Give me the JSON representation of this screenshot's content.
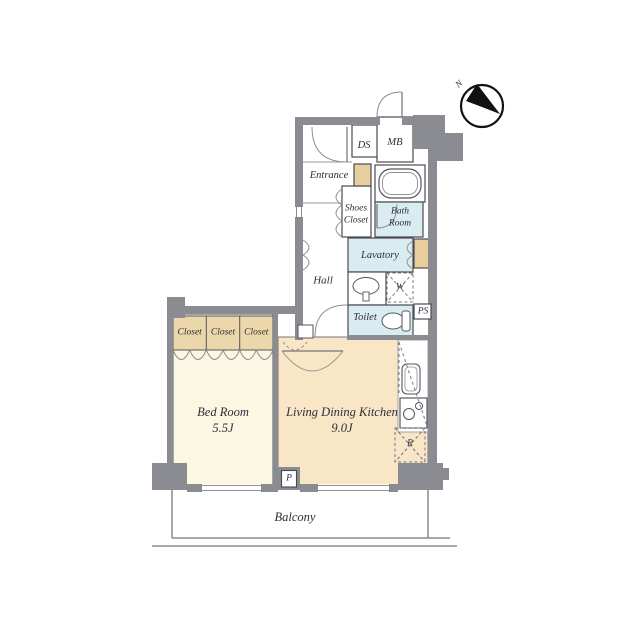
{
  "plan_type": "apartment-floor-plan",
  "compass": {
    "north_label": "N"
  },
  "rooms": {
    "entrance": "Entrance",
    "ds": "DS",
    "mb": "MB",
    "shoes_closet_line1": "Shoes",
    "shoes_closet_line2": "Closet",
    "bath_line1": "Bath",
    "bath_line2": "Room",
    "lavatory": "Lavatory",
    "hall": "Hall",
    "washer": "W",
    "toilet": "Toilet",
    "ps": "PS",
    "closet1": "Closet",
    "closet2": "Closet",
    "closet3": "Closet",
    "bedroom_name": "Bed Room",
    "bedroom_size": "5.5J",
    "ldk_name": "Living Dining Kitchen",
    "ldk_size": "9.0J",
    "pillar_p": "P",
    "refrigerator": "R",
    "balcony": "Balcony"
  },
  "colors": {
    "wall": "#8b8b92",
    "line": "#4a4a52",
    "closet_tan": "#ecd7ab",
    "cabinet_tan": "#e8cd9d",
    "bedroom_cream": "#fbf7e3",
    "ldk_peach": "#f9e6c7",
    "wet_area_blue": "#d9edf0",
    "text": "#2e2e38"
  }
}
